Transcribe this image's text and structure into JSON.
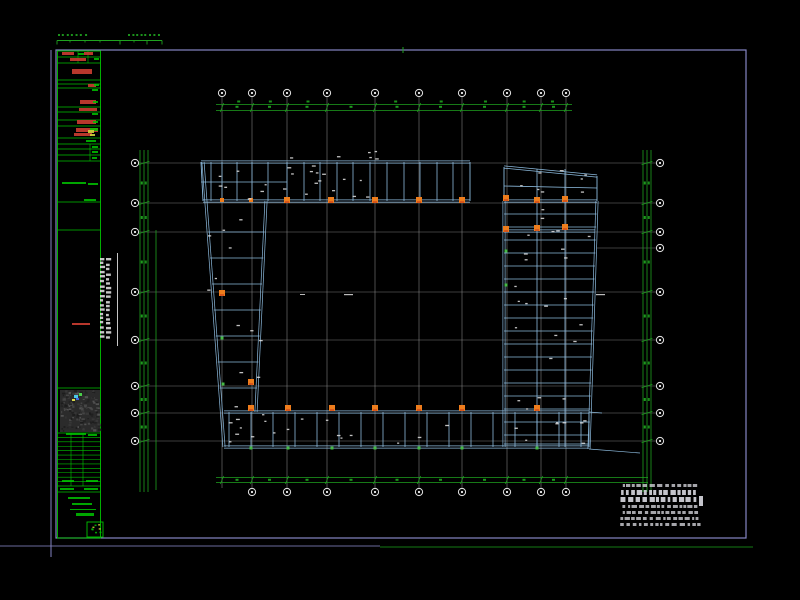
{
  "drawing": {
    "kind": "structural framing plan (CAD sheet, plan view of ring-shaped building)",
    "background": "#000000"
  },
  "colors": {
    "frame": "#8585c3",
    "green": "#1fa21f",
    "tableGreen": "#00c300",
    "beam": "#8cbadd",
    "gridline": "#989898",
    "bubble": "#e6e6e6",
    "white": "#dcdcdc",
    "orange": "#ee7d1c",
    "orangeDeep": "#d9561b",
    "colGreen": "#46bb46",
    "red": "#c23a2e",
    "yellow": "#cfd23a",
    "noteText": "#cfcfd6",
    "thumbBase": "#2b2b2b"
  },
  "sheet": {
    "frame": {
      "x": 56,
      "y": 50,
      "w": 690,
      "h": 488
    },
    "outer_left_line": {
      "x": 51,
      "y1": 50,
      "y2": 557
    },
    "bottom_line_purple": {
      "y": 546,
      "x1": 0,
      "x2": 380
    },
    "bottom_line_green": {
      "y": 547,
      "x1": 380,
      "x2": 753
    },
    "frame_tick_green": {
      "x": 403,
      "y1": 47,
      "y2": 53
    }
  },
  "ruler": {
    "y": 40.5,
    "x1": 57,
    "x2": 162,
    "ticks_long": [
      57,
      120,
      147,
      162
    ],
    "ticks_short": [
      70,
      85,
      100,
      134
    ],
    "text_rows": [
      {
        "y": 36,
        "x1": 58,
        "x2": 88
      },
      {
        "y": 36,
        "x1": 128,
        "x2": 158
      }
    ]
  },
  "title_block": {
    "x1": 57.5,
    "x2": 100.5,
    "y1": 51,
    "y2": 538,
    "row_lines": [
      57,
      63,
      80,
      84,
      88,
      107,
      112,
      120,
      126,
      138,
      144,
      149,
      155,
      161,
      202,
      230,
      388,
      433,
      486,
      492
    ],
    "dense_table": {
      "y1": 433,
      "y2": 486,
      "lines": 11,
      "verticals": [
        71,
        83
      ]
    },
    "dividers": [
      {
        "x": 78,
        "y1": 51,
        "y2": 63
      },
      {
        "x": 88,
        "y1": 51,
        "y2": 63
      },
      {
        "x": 90,
        "y1": 144,
        "y2": 161
      }
    ],
    "red_marks": [
      [
        62,
        52,
        12,
        3
      ],
      [
        84,
        52,
        9,
        3
      ],
      [
        70,
        58,
        16,
        3
      ],
      [
        72,
        69,
        20,
        5
      ],
      [
        88,
        84,
        8,
        3
      ],
      [
        80,
        100,
        16,
        4
      ],
      [
        79,
        108,
        18,
        3
      ],
      [
        77,
        120,
        19,
        4
      ],
      [
        76,
        128,
        22,
        4
      ],
      [
        74,
        133,
        18,
        3
      ],
      [
        72,
        323,
        18,
        2
      ]
    ],
    "green_marks": [
      [
        78,
        53,
        6,
        2
      ],
      [
        94,
        58,
        5,
        2
      ],
      [
        94,
        84,
        5,
        2
      ],
      [
        92,
        89,
        6,
        2
      ],
      [
        93,
        101,
        5,
        2
      ],
      [
        92,
        113,
        6,
        2
      ],
      [
        93,
        121,
        5,
        2
      ],
      [
        90,
        128,
        8,
        3
      ],
      [
        86,
        140,
        10,
        2
      ],
      [
        92,
        146,
        6,
        2
      ],
      [
        92,
        151,
        6,
        2
      ],
      [
        92,
        157,
        5,
        2
      ],
      [
        62,
        182,
        24,
        2
      ],
      [
        88,
        183,
        10,
        2
      ],
      [
        84,
        199,
        12,
        2
      ],
      [
        66,
        433,
        20,
        2
      ],
      [
        88,
        434,
        9,
        2
      ],
      [
        62,
        480,
        12,
        2
      ],
      [
        86,
        480,
        12,
        2
      ],
      [
        60,
        488,
        14,
        2
      ],
      [
        84,
        488,
        14,
        2
      ],
      [
        68,
        497,
        22,
        2
      ],
      [
        72,
        503,
        20,
        2
      ],
      [
        70,
        509,
        26,
        1
      ],
      [
        76,
        513,
        18,
        3
      ]
    ],
    "yellow_marks": [
      [
        88,
        130,
        6,
        3
      ],
      [
        90,
        134,
        5,
        2
      ]
    ],
    "thumbnail": {
      "x": 60,
      "y": 390,
      "w": 40,
      "h": 42,
      "accents": [
        [
          74,
          395,
          4,
          3,
          "#49c8e8"
        ],
        [
          79,
          393,
          3,
          3,
          "#4ad04a"
        ],
        [
          72,
          399,
          3,
          2,
          "#d8d84a"
        ],
        [
          76,
          398,
          3,
          2,
          "#3a6ae0"
        ]
      ]
    },
    "stamp": {
      "x": 87,
      "y": 522,
      "w": 16,
      "h": 15
    }
  },
  "vertical_title": {
    "line": {
      "x": 117.5,
      "y1": 253,
      "y2": 346
    },
    "text_cols": [
      {
        "x": 100,
        "w": 5
      },
      {
        "x": 106,
        "w": 5
      }
    ],
    "y1": 258,
    "y2": 338
  },
  "grid": {
    "vertical": {
      "xs": [
        222,
        252,
        287,
        327,
        375,
        419,
        462,
        507,
        541,
        566
      ],
      "y1": 97,
      "y2": 488,
      "bubble_top_y": 93,
      "bubble_bottom_y": 492
    },
    "horizontal": {
      "ys": [
        163,
        203,
        232,
        292,
        340,
        386,
        413,
        441
      ],
      "x1": 139,
      "x2": 656,
      "left_bubble_x": 135,
      "right_bubble_x": 660,
      "right_only_ys": [
        248
      ],
      "right_only_x1": 597
    }
  },
  "dims": {
    "top": {
      "ys": [
        104.5,
        110.5
      ],
      "x1": 216,
      "x2": 572
    },
    "bottom": {
      "ys": [
        477.5,
        482.5
      ],
      "x1": 216,
      "x2": 648
    },
    "left": {
      "xs": [
        140,
        144,
        148
      ],
      "y1": 150,
      "y2": 492,
      "extra": {
        "x": 156,
        "y1": 230,
        "y2": 490
      }
    },
    "right": {
      "xs": [
        643,
        647,
        651
      ],
      "y1": 150,
      "y2": 492
    }
  },
  "structure": {
    "top_band": {
      "x1": 201,
      "x2": 470,
      "y_top": 162,
      "y_bot": 201,
      "mid_y": 182,
      "mid_x2": 287,
      "verticals": [
        211,
        222,
        237,
        252,
        268,
        287,
        304,
        320,
        337,
        353,
        370,
        387,
        404,
        420,
        437,
        453
      ]
    },
    "wing": {
      "x1": 504,
      "x2": 597,
      "y_top_l": 167,
      "y_top_r": 176,
      "y_bot": 201,
      "mid_y": 186,
      "verticals": [
        537,
        565
      ],
      "beam2_y": 231,
      "beam2_x2": 595
    },
    "right_band": {
      "x_left": 504,
      "y_top": 201,
      "y_bot": 447,
      "right_top": [
        597,
        201
      ],
      "right_bot": [
        589,
        449
      ],
      "beam_ys": [
        214,
        227,
        240,
        253,
        266,
        279,
        292,
        305,
        318,
        331,
        344,
        357,
        370,
        383,
        396,
        409,
        422,
        435,
        444
      ],
      "verticals": [
        537,
        565
      ]
    },
    "left_band": {
      "edge_l": {
        "x1": 203,
        "y1": 162,
        "x2": 224,
        "y2": 447
      },
      "edge_r": {
        "x1": 266,
        "y1": 201,
        "x2": 256,
        "y2": 412
      },
      "beam_ys": [
        232,
        258,
        284,
        310,
        336,
        362,
        388
      ]
    },
    "bottom_band": {
      "x1": 224,
      "x2": 589,
      "y_top": 412,
      "y_bot": 447,
      "verticals": [
        229,
        251,
        273,
        295,
        317,
        339,
        361,
        383,
        405,
        427,
        449,
        471,
        493,
        515,
        537,
        559,
        581
      ],
      "tails": [
        [
          589,
          449,
          640,
          453
        ],
        [
          589,
          412,
          602,
          413
        ]
      ]
    }
  },
  "columns": {
    "orange_big": [
      [
        287,
        200
      ],
      [
        331,
        200
      ],
      [
        375,
        200
      ],
      [
        419,
        200
      ],
      [
        462,
        200
      ],
      [
        506,
        198
      ],
      [
        537,
        200
      ],
      [
        565,
        199
      ],
      [
        506,
        229
      ],
      [
        537,
        228
      ],
      [
        565,
        227
      ],
      [
        251,
        408
      ],
      [
        288,
        408
      ],
      [
        332,
        408
      ],
      [
        375,
        408
      ],
      [
        419,
        408
      ],
      [
        462,
        408
      ],
      [
        537,
        408
      ],
      [
        222,
        293
      ],
      [
        251,
        382
      ]
    ],
    "orange_small": [
      [
        222,
        200
      ],
      [
        251,
        200
      ]
    ],
    "green_small": [
      [
        251,
        448
      ],
      [
        288,
        448
      ],
      [
        332,
        448
      ],
      [
        375,
        448
      ],
      [
        419,
        448
      ],
      [
        462,
        448
      ],
      [
        537,
        448
      ],
      [
        506,
        251
      ],
      [
        506,
        285
      ],
      [
        222,
        338
      ],
      [
        223,
        384
      ]
    ]
  },
  "labels_scatter": [
    [
      205,
      165,
      465,
      199,
      22
    ],
    [
      506,
      170,
      594,
      199,
      8
    ],
    [
      506,
      205,
      590,
      444,
      26
    ],
    [
      226,
      414,
      586,
      445,
      24
    ],
    [
      206,
      205,
      262,
      408,
      12
    ],
    [
      210,
      150,
      460,
      159,
      6
    ]
  ],
  "center_marks": [
    [
      344,
      294,
      9,
      1.2
    ],
    [
      596,
      294,
      9,
      1.2
    ],
    [
      300,
      294,
      5,
      1
    ]
  ],
  "notes": {
    "x1": 620,
    "x2": 701,
    "rows": [
      {
        "y": 484,
        "h": 3
      },
      {
        "y": 490,
        "h": 5
      },
      {
        "y": 497,
        "h": 5
      },
      {
        "y": 505,
        "h": 3
      },
      {
        "y": 511,
        "h": 3
      },
      {
        "y": 517,
        "h": 3
      },
      {
        "y": 523,
        "h": 3
      }
    ],
    "side_block": [
      699,
      496,
      4,
      10
    ]
  }
}
